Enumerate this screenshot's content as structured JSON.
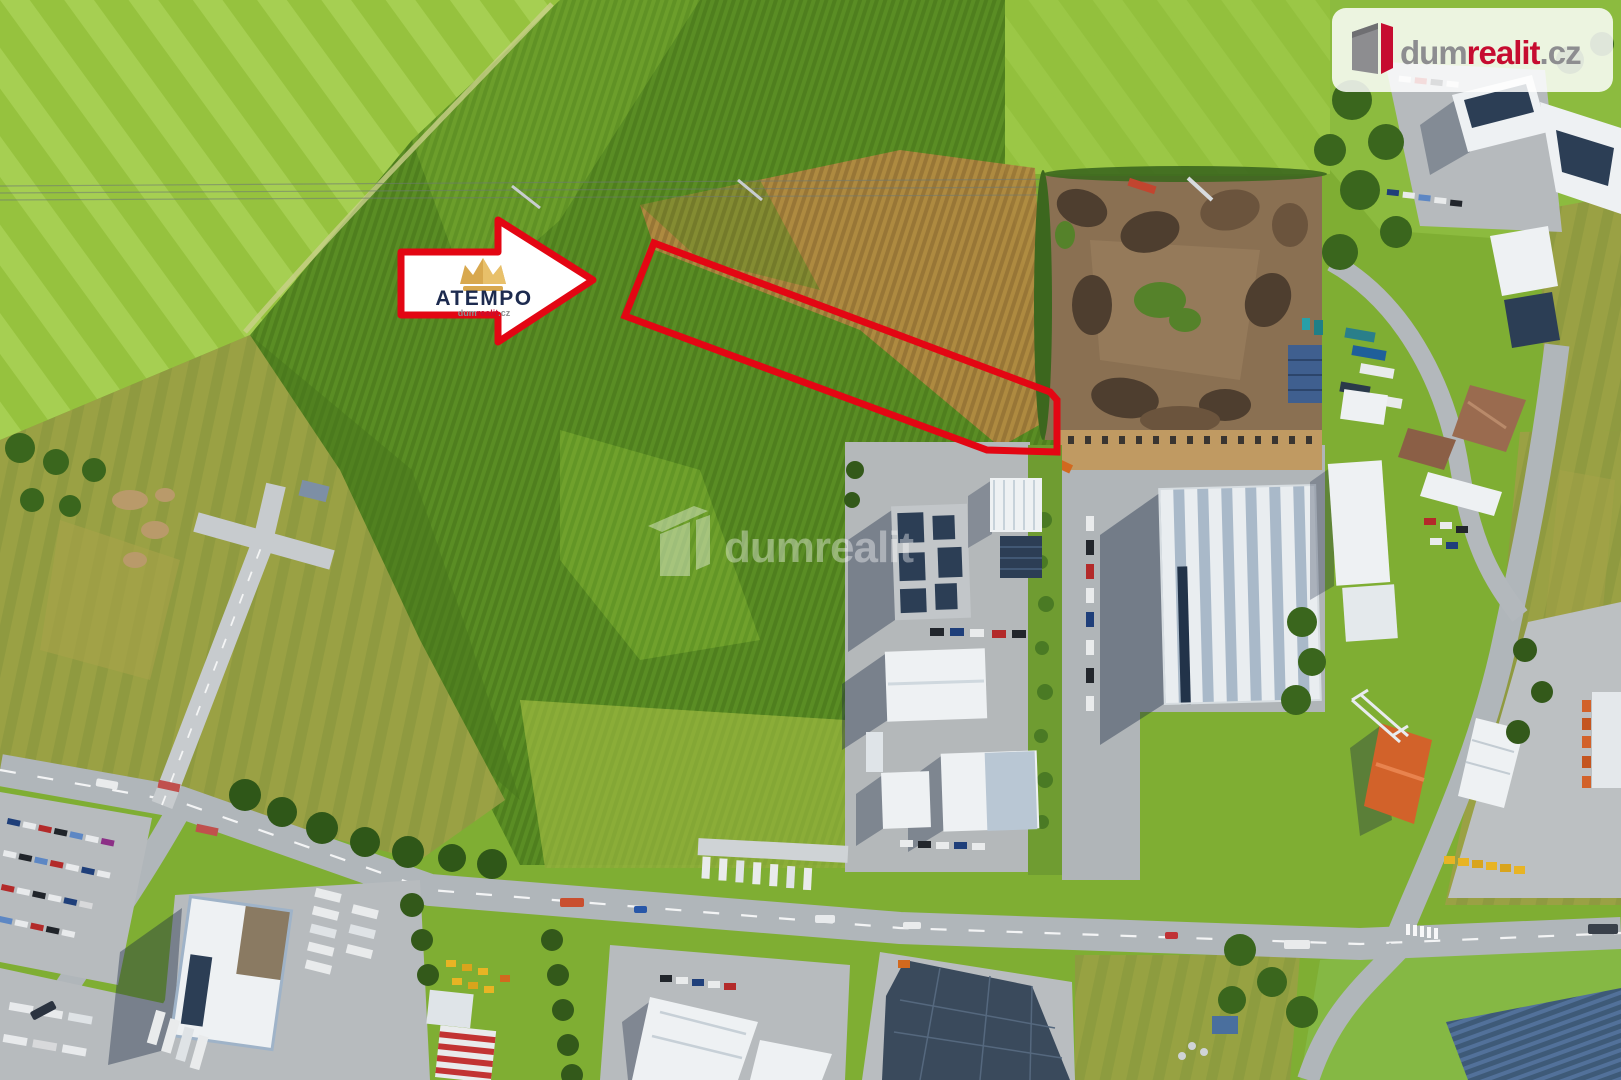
{
  "meta": {
    "kind": "aerial-drone-photo-real-estate-listing",
    "width_px": 1621,
    "height_px": 1080
  },
  "branding": {
    "logo_card": {
      "part_dum": "dum",
      "part_realit": "realit",
      "part_cz": ".cz",
      "color_gray": "#8d8d90",
      "color_red": "#c60c30",
      "card_bg": "rgba(255,255,255,0.84)"
    },
    "watermark": {
      "text": "dumrealit",
      "color": "rgba(255,255,255,0.38)"
    },
    "arrow_badge": {
      "title": "ATEMPO",
      "subtitle_dum": "dum",
      "subtitle_realit": "realit",
      "subtitle_cz": ".cz",
      "title_color": "#1d2b4f",
      "crown_gold": "#d8a84e",
      "crown_gold_light": "#e8c06a",
      "arrow_fill": "#ffffff",
      "arrow_border": "#e30613"
    }
  },
  "overlay": {
    "parcel_outline_color": "#e30613",
    "parcel_stroke_width": 7
  },
  "palette": {
    "meadow_bright": "#96c23e",
    "meadow_stripe": "#a6cf52",
    "crop_green_dark": "#4f7f1e",
    "crop_green": "#5a8d24",
    "crop_yellow_green": "#a9ba46",
    "dry_crop_tan": "#ab8340",
    "olive_scrub": "#9aa144",
    "facility_dirt": "#8a7052",
    "compost_dark": "#4e3e2f",
    "road_gray": "#b0b6ba",
    "concrete_light": "#b7bbbe",
    "roof_white": "#e9edf0",
    "roof_stripe_gray": "#a9b9c9",
    "solar_panel_navy": "#2c3e55",
    "lawn_green": "#85b844",
    "tree_dark_green": "#33591a",
    "shadow_blue": "rgba(25,40,65,0.38)",
    "orange_roof": "#d2622a",
    "machine_yellow": "#e8b424"
  }
}
